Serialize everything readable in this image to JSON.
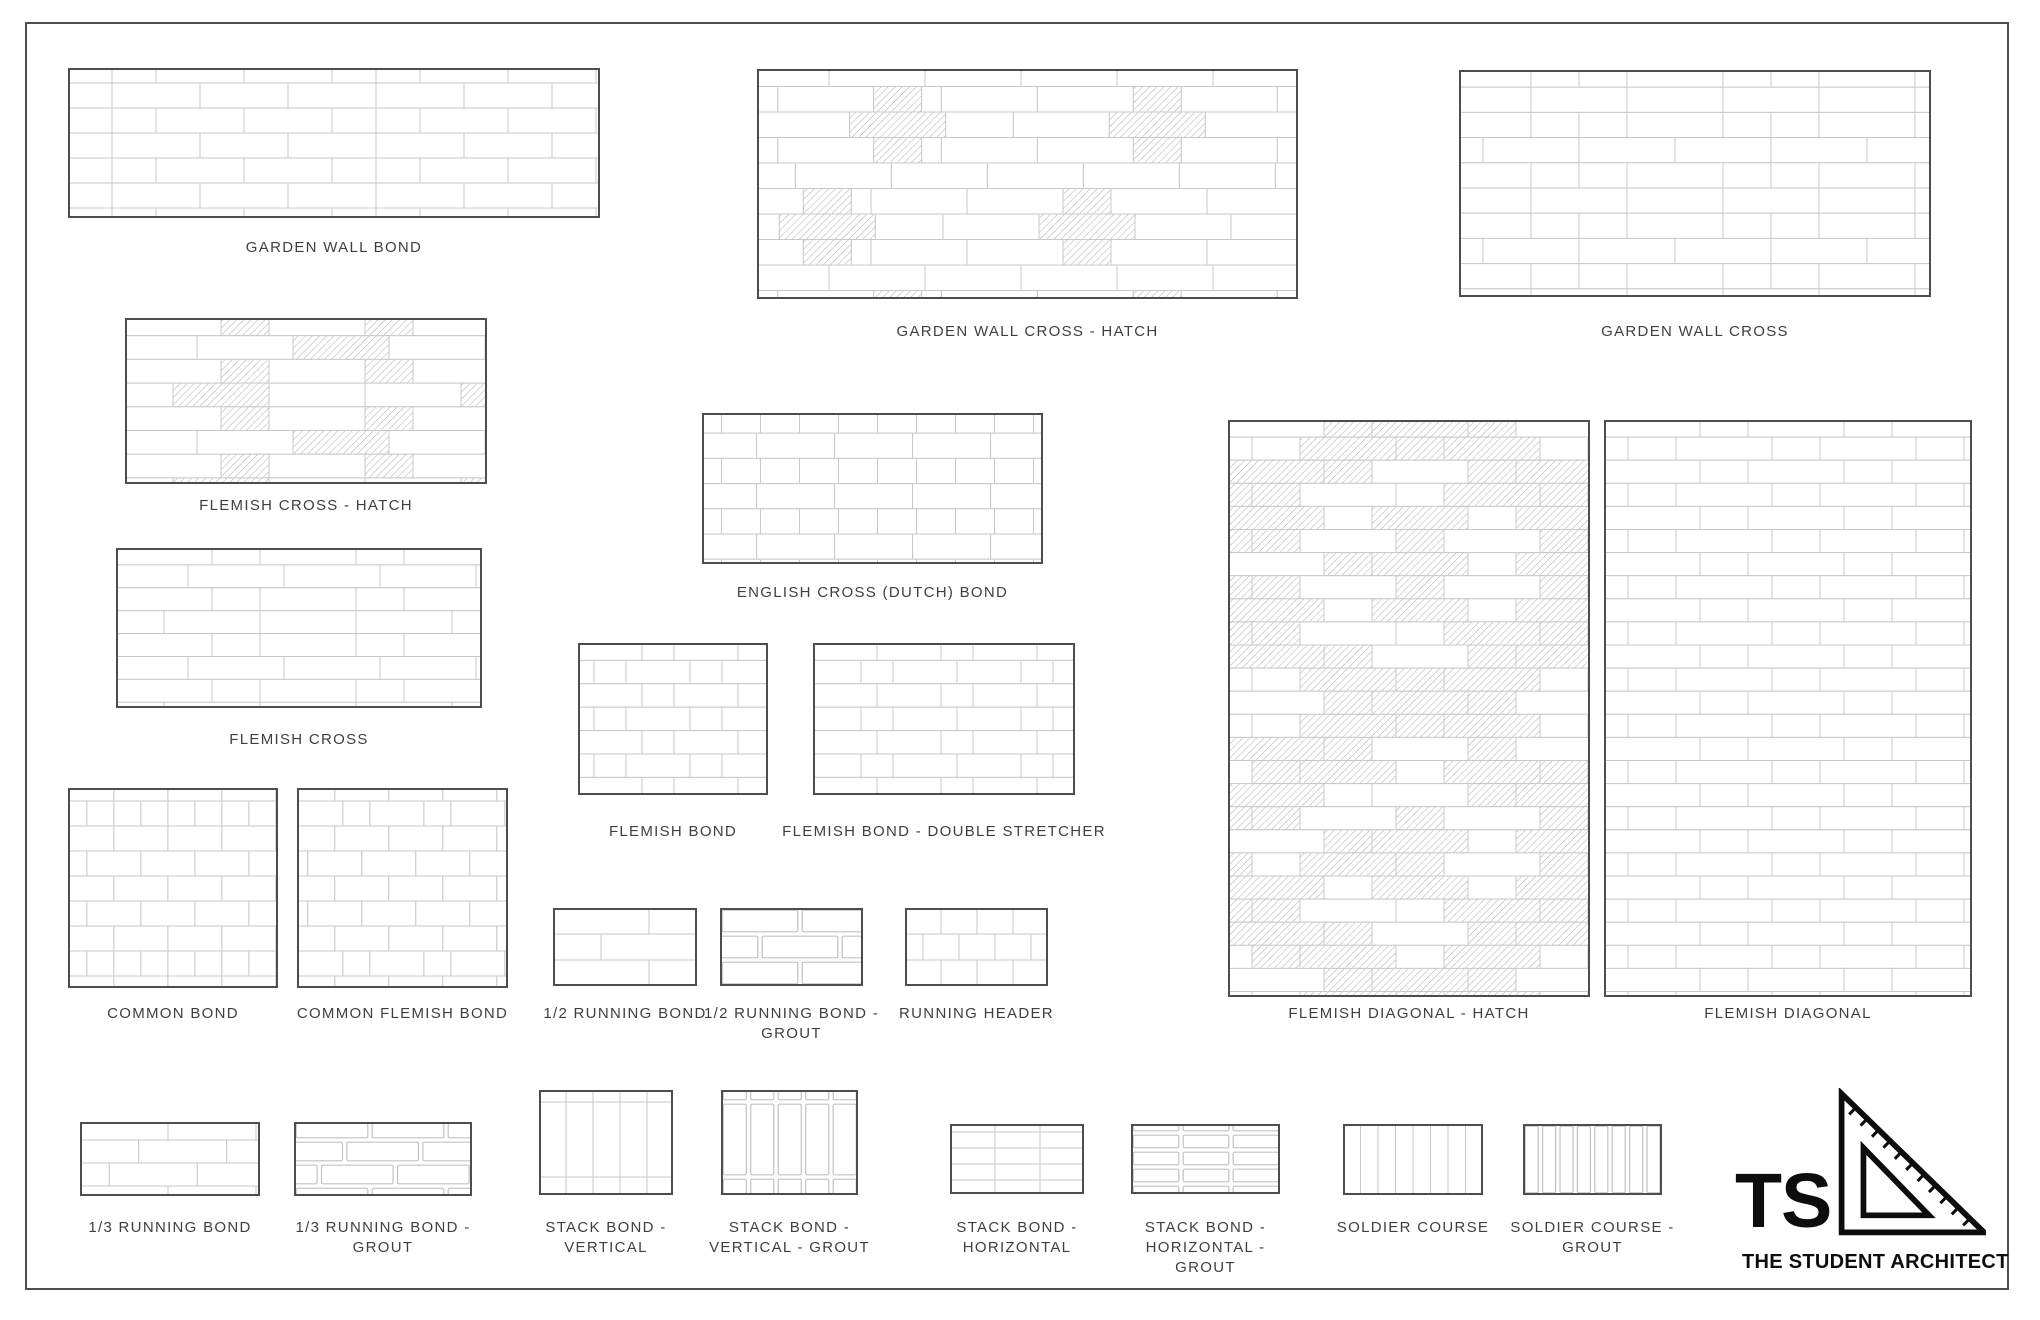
{
  "colors": {
    "line": "#c9c9c9",
    "grout_line": "#c2c2c2",
    "border": "#4d4d4d",
    "hatch": "#b2b2b2",
    "label_text": "#3f3f3f",
    "logo": "#0d0d0d",
    "background": "#ffffff"
  },
  "logo": {
    "monogram": "TS",
    "name": "THE STUDENT ARCHITECT",
    "icon": "set-square-triangle-icon"
  },
  "panels": [
    {
      "id": "garden-wall-bond",
      "label": "GARDEN WALL BOND",
      "x": 68,
      "y": 68,
      "w": 532,
      "h": 150,
      "labelY": 238,
      "pattern": {
        "type": "garden-wall",
        "unit": 44,
        "ch": 25,
        "y0": -10
      }
    },
    {
      "id": "garden-wall-cross-hatch",
      "label": "GARDEN WALL CROSS - HATCH",
      "x": 757,
      "y": 69,
      "w": 541,
      "h": 230,
      "labelY": 322,
      "pattern": {
        "type": "garden-wall-cross-hatch",
        "unit": 48,
        "ch": 25.5,
        "y0": -8,
        "crossA": [
          0.26,
          0.74
        ],
        "crossB": [
          0.13,
          0.61
        ]
      }
    },
    {
      "id": "garden-wall-cross",
      "label": "GARDEN WALL CROSS",
      "x": 1459,
      "y": 70,
      "w": 472,
      "h": 227,
      "labelY": 322,
      "pattern": {
        "type": "garden-wall-cross",
        "unit": 48,
        "ch": 25.2,
        "y0": -8
      }
    },
    {
      "id": "flemish-cross-hatch",
      "label": "FLEMISH CROSS - HATCH",
      "x": 125,
      "y": 318,
      "w": 362,
      "h": 166,
      "labelY": 496,
      "pattern": {
        "type": "flemish-cross",
        "unit": 48,
        "ch": 23.7,
        "y0": -6,
        "hatch": true
      }
    },
    {
      "id": "english-cross",
      "label": "ENGLISH CROSS (DUTCH) BOND",
      "x": 702,
      "y": 413,
      "w": 341,
      "h": 151,
      "labelY": 583,
      "pattern": {
        "type": "english-cross",
        "unit": 39,
        "ch": 25.2,
        "y0": -5
      }
    },
    {
      "id": "flemish-cross",
      "label": "FLEMISH CROSS",
      "x": 116,
      "y": 548,
      "w": 366,
      "h": 160,
      "labelY": 730,
      "pattern": {
        "type": "flemish-cross",
        "unit": 48,
        "ch": 22.9,
        "y0": -6,
        "hatch": false
      }
    },
    {
      "id": "flemish-bond",
      "label": "FLEMISH BOND",
      "x": 578,
      "y": 643,
      "w": 190,
      "h": 152,
      "labelY": 822,
      "pattern": {
        "type": "flemish",
        "unit": 32,
        "ch": 23.4,
        "y0": -6
      }
    },
    {
      "id": "flemish-bond-double",
      "label": "FLEMISH BOND - DOUBLE STRETCHER",
      "x": 813,
      "y": 643,
      "w": 262,
      "h": 152,
      "labelY": 822,
      "pattern": {
        "type": "flemish-double",
        "unit": 32,
        "ch": 23.4,
        "y0": -6
      }
    },
    {
      "id": "common-bond",
      "label": "COMMON BOND",
      "x": 68,
      "y": 788,
      "w": 210,
      "h": 200,
      "labelY": 1004,
      "pattern": {
        "type": "common",
        "unit": 27,
        "ch": 25,
        "y0": -12
      }
    },
    {
      "id": "common-flemish-bond",
      "label": "COMMON FLEMISH BOND",
      "x": 297,
      "y": 788,
      "w": 211,
      "h": 200,
      "labelY": 1004,
      "pattern": {
        "type": "common-flemish",
        "unit": 27,
        "ch": 25,
        "y0": -12
      }
    },
    {
      "id": "half-running-bond",
      "label": "1/2 RUNNING BOND",
      "x": 553,
      "y": 908,
      "w": 144,
      "h": 78,
      "labelY": 1004,
      "pattern": {
        "type": "running",
        "unit": 48,
        "ch": 26,
        "y0": 0,
        "frac": 0.5
      }
    },
    {
      "id": "half-running-bond-grout",
      "label": "1/2 RUNNING BOND -\nGROUT",
      "x": 720,
      "y": 908,
      "w": 143,
      "h": 78,
      "labelY": 1004,
      "pattern": {
        "type": "running",
        "unit": 40,
        "ch": 26,
        "y0": 0,
        "frac": 0.5,
        "grout": true
      }
    },
    {
      "id": "running-header",
      "label": "RUNNING HEADER",
      "x": 905,
      "y": 908,
      "w": 143,
      "h": 78,
      "labelY": 1004,
      "pattern": {
        "type": "running-header",
        "unit": 36,
        "ch": 26,
        "y0": 0
      }
    },
    {
      "id": "flemish-diagonal-hatch",
      "label": "FLEMISH DIAGONAL - HATCH",
      "x": 1228,
      "y": 420,
      "w": 362,
      "h": 577,
      "labelY": 1004,
      "pattern": {
        "type": "flemish-diagonal",
        "unit": 48,
        "ch": 23.1,
        "y0": -6,
        "hatch": true,
        "V": 288,
        "vphase": 0
      }
    },
    {
      "id": "flemish-diagonal",
      "label": "FLEMISH DIAGONAL",
      "x": 1604,
      "y": 420,
      "w": 368,
      "h": 577,
      "labelY": 1004,
      "pattern": {
        "type": "flemish-diagonal",
        "unit": 48,
        "ch": 23.1,
        "y0": -6,
        "hatch": false,
        "V": 288,
        "vphase": 0
      }
    },
    {
      "id": "third-running-bond",
      "label": "1/3 RUNNING BOND",
      "x": 80,
      "y": 1122,
      "w": 180,
      "h": 74,
      "labelY": 1218,
      "pattern": {
        "type": "running",
        "unit": 44,
        "ch": 23,
        "y0": -5,
        "frac": 0.3333
      }
    },
    {
      "id": "third-running-bond-grout",
      "label": "1/3 RUNNING BOND -\nGROUT",
      "x": 294,
      "y": 1122,
      "w": 178,
      "h": 74,
      "labelY": 1218,
      "pattern": {
        "type": "running",
        "unit": 38,
        "ch": 23,
        "y0": -5,
        "frac": 0.3333,
        "grout": true
      }
    },
    {
      "id": "stack-bond-vertical",
      "label": "STACK BOND -\nVERTICAL",
      "x": 539,
      "y": 1090,
      "w": 134,
      "h": 105,
      "labelY": 1218,
      "pattern": {
        "type": "stack-vertical",
        "bw": 27,
        "bh": 75,
        "vy0": -63
      }
    },
    {
      "id": "stack-bond-vertical-grout",
      "label": "STACK BOND -\nVERTICAL - GROUT",
      "x": 721,
      "y": 1090,
      "w": 137,
      "h": 105,
      "labelY": 1218,
      "pattern": {
        "type": "stack-vertical",
        "bw": 27.5,
        "bh": 75,
        "vy0": -63,
        "grout": true
      }
    },
    {
      "id": "stack-bond-horizontal",
      "label": "STACK BOND -\nHORIZONTAL",
      "x": 950,
      "y": 1124,
      "w": 134,
      "h": 70,
      "labelY": 1218,
      "pattern": {
        "type": "stack-horizontal",
        "bw": 45,
        "ch": 16,
        "y0": -8
      }
    },
    {
      "id": "stack-bond-horizontal-grout",
      "label": "STACK BOND -\nHORIZONTAL -\nGROUT",
      "x": 1131,
      "y": 1124,
      "w": 149,
      "h": 70,
      "labelY": 1218,
      "pattern": {
        "type": "stack-horizontal",
        "bw": 50,
        "ch": 17,
        "y0": -8,
        "grout": true
      }
    },
    {
      "id": "soldier-course",
      "label": "SOLDIER COURSE",
      "x": 1343,
      "y": 1124,
      "w": 140,
      "h": 71,
      "labelY": 1218,
      "pattern": {
        "type": "soldier",
        "bw": 17.5
      }
    },
    {
      "id": "soldier-course-grout",
      "label": "SOLDIER COURSE -\nGROUT",
      "x": 1523,
      "y": 1124,
      "w": 139,
      "h": 71,
      "labelY": 1218,
      "pattern": {
        "type": "soldier",
        "bw": 17.4,
        "grout": true
      }
    }
  ]
}
